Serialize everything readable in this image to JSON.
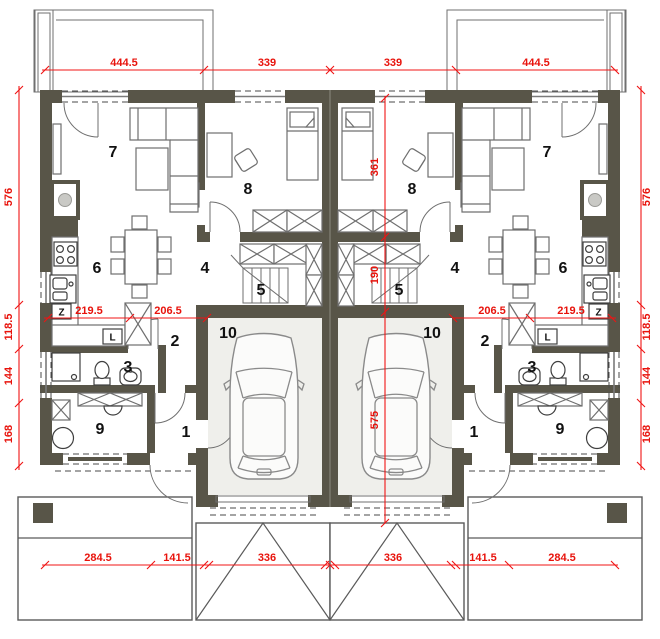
{
  "plan": {
    "type": "twin-house-floor-plan",
    "colors": {
      "wall": "#585548",
      "dimension": "#f01414",
      "garage_floor": "#efefeb",
      "furniture_line": "#6f6f6f"
    },
    "rooms": {
      "living": "7",
      "bedroom": "8",
      "kitchen": "6",
      "hall": "4",
      "stairs": "5",
      "corridor": "2",
      "bathroom": "3",
      "utility": "9",
      "entry": "1",
      "garage": "10"
    },
    "appliances": {
      "fridge": "L",
      "dishwasher": "Z"
    },
    "dims": {
      "top": [
        "444.5",
        "339",
        "339",
        "444.5"
      ],
      "bottom": [
        "284.5",
        "141.5",
        "336",
        "336",
        "141.5",
        "284.5"
      ],
      "left": [
        "576",
        "118.5",
        "144",
        "168"
      ],
      "right": [
        "576",
        "118.5",
        "144",
        "168"
      ],
      "inner_left": [
        "219.5",
        "206.5"
      ],
      "inner_right": [
        "206.5",
        "219.5"
      ],
      "inner_vertical": [
        "361",
        "190",
        "575"
      ]
    }
  }
}
